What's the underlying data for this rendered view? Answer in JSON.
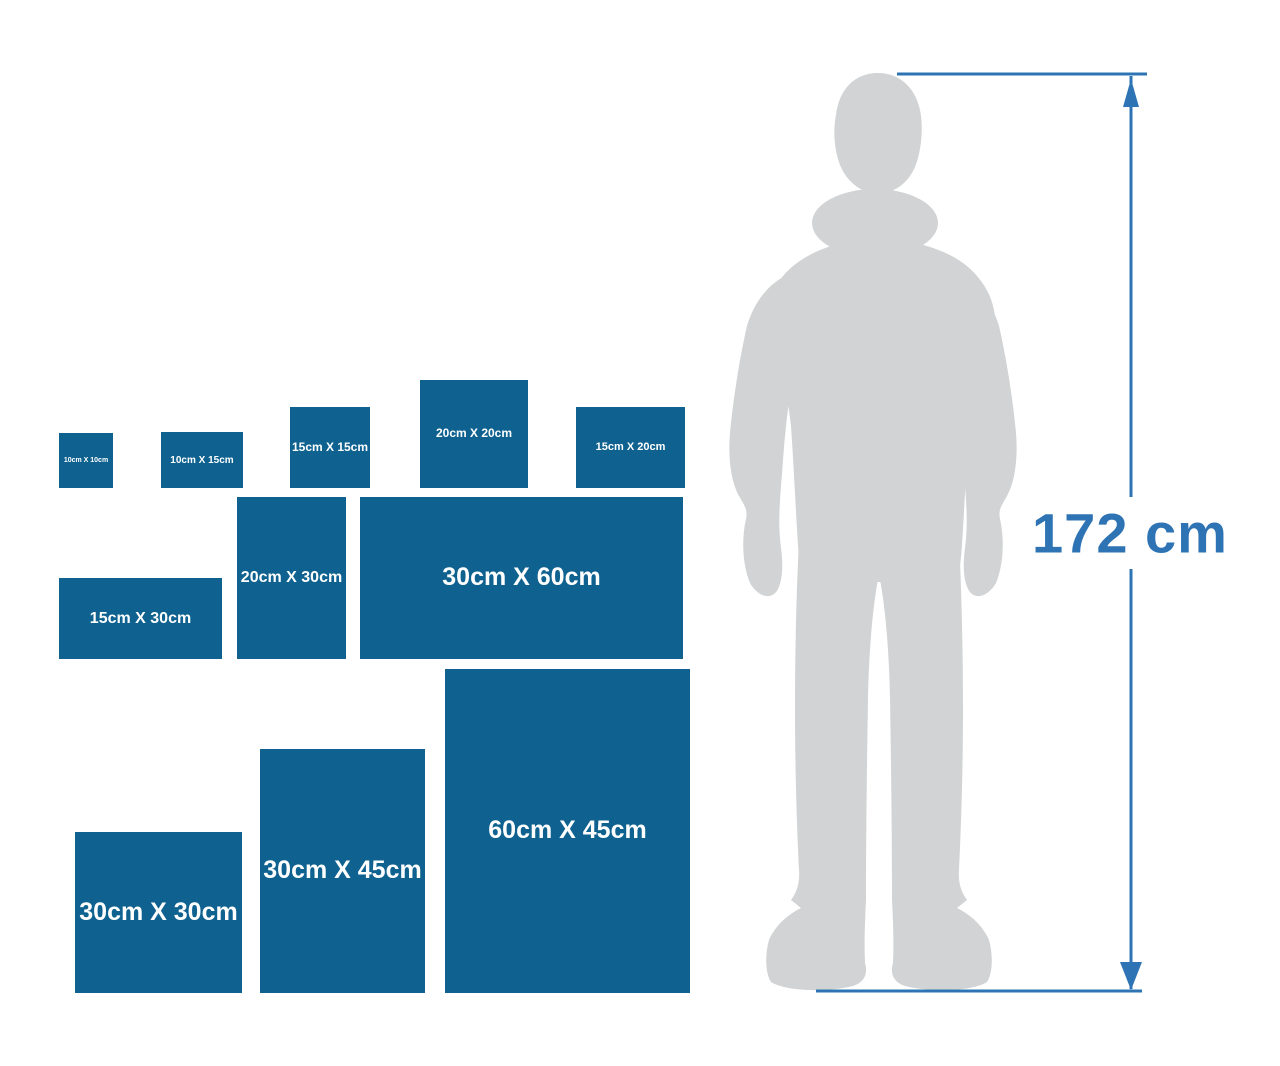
{
  "canvas": {
    "width": 1280,
    "height": 1066,
    "background": "#ffffff"
  },
  "size_chart": {
    "box_color": "#0f6290",
    "label_color": "#ffffff",
    "scale_px_per_cm": 5.4,
    "boxes": [
      {
        "id": "10x10",
        "label": "10cm X 10cm",
        "x": 59,
        "y": 433,
        "w": 54,
        "h": 55,
        "font_px": 7
      },
      {
        "id": "10x15",
        "label": "10cm X 15cm",
        "x": 161,
        "y": 432,
        "w": 82,
        "h": 56,
        "font_px": 10
      },
      {
        "id": "15x15",
        "label": "15cm X 15cm",
        "x": 290,
        "y": 407,
        "w": 80,
        "h": 81,
        "font_px": 12
      },
      {
        "id": "20x20",
        "label": "20cm X 20cm",
        "x": 420,
        "y": 380,
        "w": 108,
        "h": 108,
        "font_px": 12
      },
      {
        "id": "15x20",
        "label": "15cm X 20cm",
        "x": 576,
        "y": 407,
        "w": 109,
        "h": 81,
        "font_px": 11
      },
      {
        "id": "15x30",
        "label": "15cm X 30cm",
        "x": 59,
        "y": 578,
        "w": 163,
        "h": 81,
        "font_px": 16
      },
      {
        "id": "20x30",
        "label": "20cm X 30cm",
        "x": 237,
        "y": 497,
        "w": 109,
        "h": 162,
        "font_px": 16
      },
      {
        "id": "30x60",
        "label": "30cm X 60cm",
        "x": 360,
        "y": 497,
        "w": 323,
        "h": 162,
        "font_px": 25
      },
      {
        "id": "30x30",
        "label": "30cm X 30cm",
        "x": 75,
        "y": 832,
        "w": 167,
        "h": 161,
        "font_px": 25
      },
      {
        "id": "30x45",
        "label": "30cm X 45cm",
        "x": 260,
        "y": 749,
        "w": 165,
        "h": 244,
        "font_px": 25
      },
      {
        "id": "60x45",
        "label": "60cm X 45cm",
        "x": 445,
        "y": 669,
        "w": 245,
        "h": 324,
        "font_px": 25
      }
    ]
  },
  "person": {
    "icon": "man-silhouette",
    "color": "#d1d3d4"
  },
  "height_indicator": {
    "label": "172 cm",
    "color": "#2e74b5"
  }
}
